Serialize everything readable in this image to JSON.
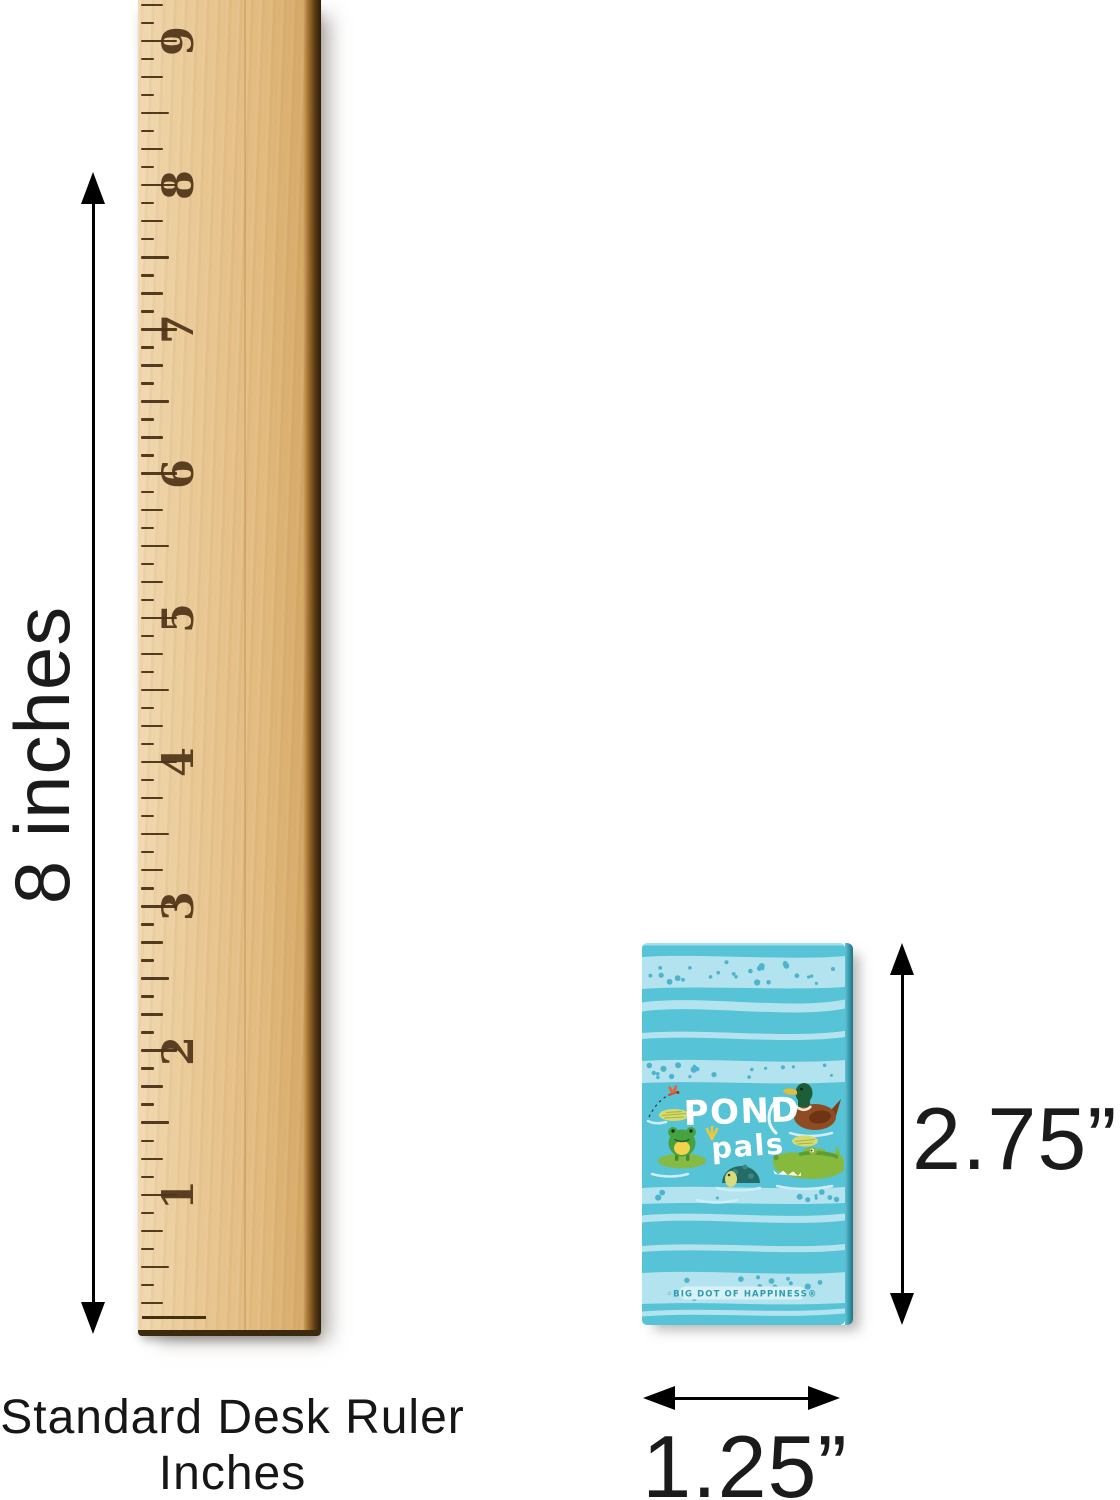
{
  "dimension_labels": {
    "ruler_height": "8 inches",
    "card_height": "2.75”",
    "card_width": "1.25”"
  },
  "caption": {
    "line1": "Standard Desk Ruler",
    "line2": "Inches"
  },
  "ruler": {
    "numbers": [
      "9",
      "8",
      "7",
      "6",
      "5",
      "4",
      "3",
      "2",
      "1"
    ],
    "unit": "inches"
  },
  "card": {
    "title_line1": "POND",
    "title_line2": "pals",
    "brand": "◦BIG DOT OF HAPPINESS®",
    "icons": [
      "dragonfly-icon",
      "lily-pad-icon",
      "frog-icon",
      "duck-icon",
      "turtle-icon",
      "alligator-icon"
    ],
    "colors": {
      "background": "#56c3d6",
      "band": "#b2e3ee",
      "dot": "#4db4cc",
      "brand_text": "#2e9cb0"
    }
  },
  "colors": {
    "annotation": "#1b1b1b",
    "wood": "#e7c28b",
    "wood_edge": "#3b2a10",
    "tick": "#452e12"
  }
}
